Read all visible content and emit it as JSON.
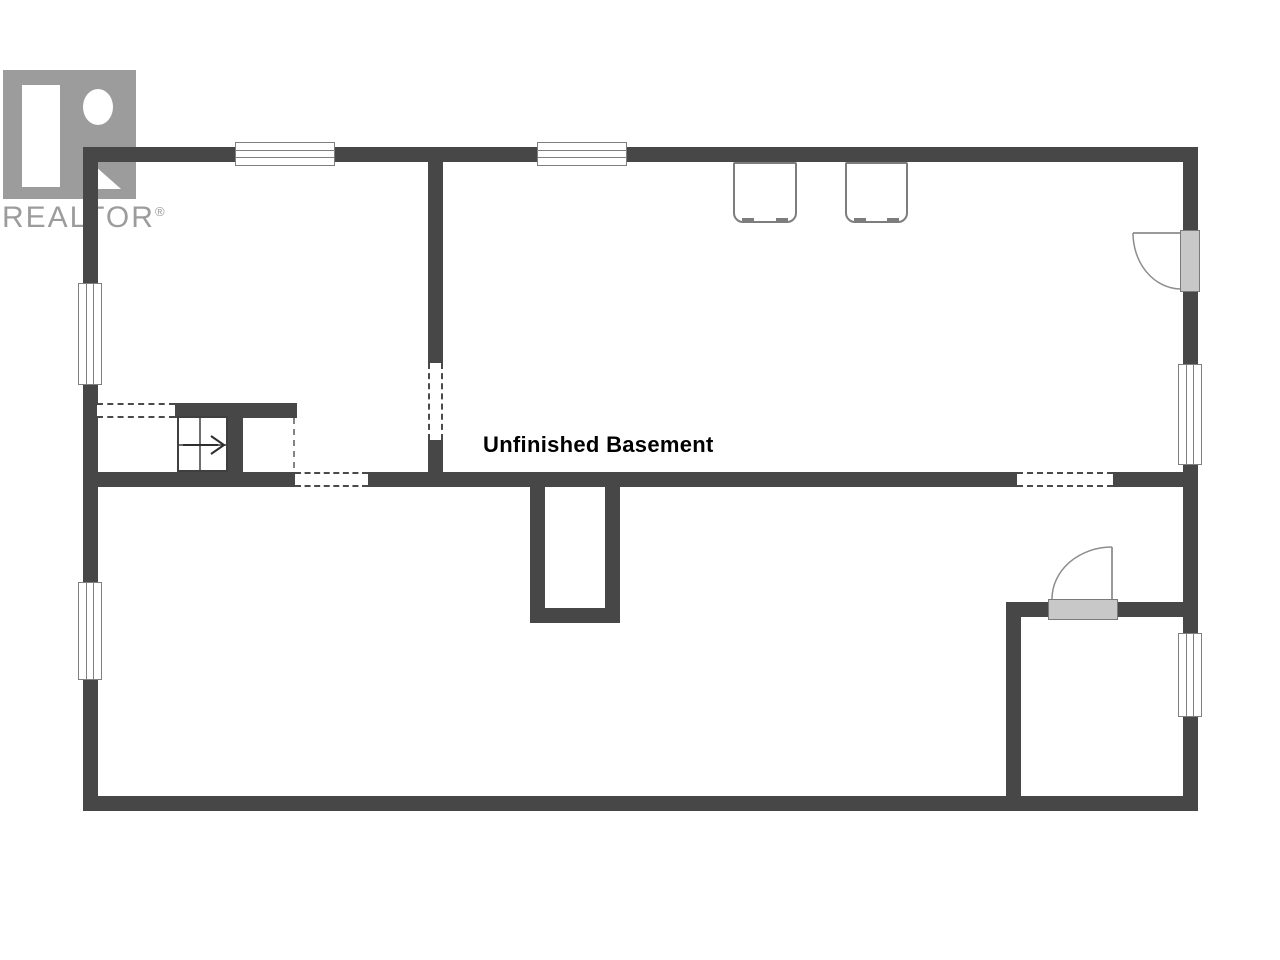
{
  "page": {
    "type": "basement floor plan",
    "background": "#ffffff"
  },
  "labels": {
    "room": "Unfinished Basement"
  },
  "logo": {
    "brand": "REALTOR",
    "registered": "®",
    "color": "#9c9c9c"
  },
  "colors": {
    "wall": "#474747",
    "door_fill": "#c8c8c8",
    "outline": "#7a7a7a",
    "label_text": "#000000"
  },
  "summary": {
    "windows": 6,
    "doors": 2,
    "appliances": 2,
    "staircases": 1,
    "dashed_openings": 4
  }
}
